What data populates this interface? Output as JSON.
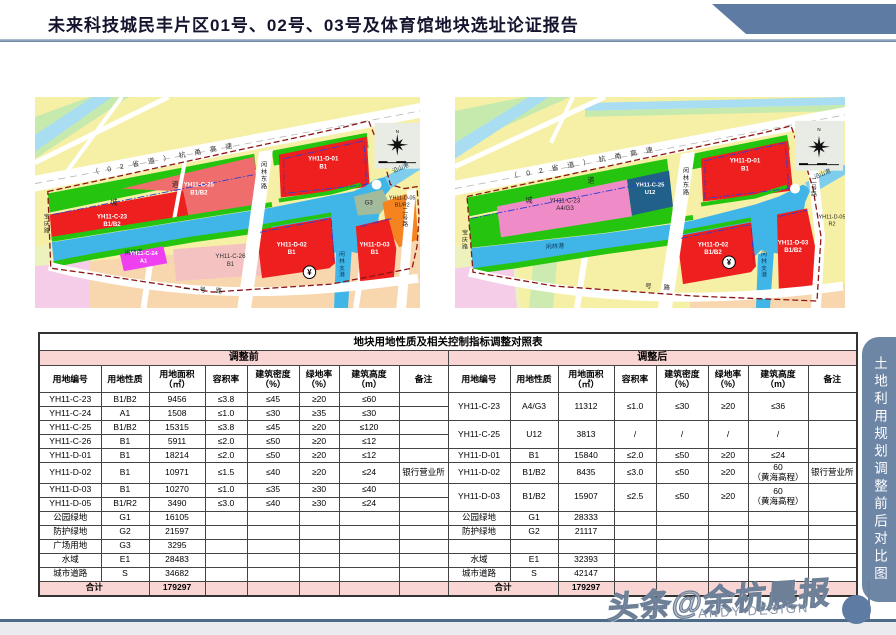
{
  "header": {
    "title": "未来科技城民丰片区01号、02号、03号及体育馆地块选址论证报告"
  },
  "side_tab": {
    "label": "土地利用规划调整前后对比图"
  },
  "footer": {
    "watermark": "头条@余杭晨报",
    "credit": "ANDY DESIGN"
  },
  "colors": {
    "banner": "#5d7ba3",
    "tab": "#6d86a6",
    "table_pink": "#f9d6d4",
    "parcel_red": "#ee1f1f",
    "water_blue": "#3fb5e8",
    "green": "#25c40f"
  },
  "maps": {
    "before": {
      "labels": [
        {
          "t": "（02省道）杭甬高速",
          "x": 58,
          "y": 78,
          "r": -10.7,
          "s": 7,
          "ls": 9,
          "a": "start",
          "c": "#333"
        },
        {
          "t": "城",
          "x": 80,
          "y": 108,
          "s": 7,
          "c": "#222"
        },
        {
          "t": "道",
          "x": 142,
          "y": 90,
          "s": 7,
          "c": "#222"
        },
        {
          "t": "宝庆路",
          "x": 12,
          "y": 122,
          "s": 6,
          "c": "#222",
          "vert": true
        },
        {
          "lines": [
            "YH11-C-23",
            "B1/B2"
          ],
          "x": 78,
          "y": 122,
          "s": 6.2,
          "c": "#ffffff",
          "w": 1
        },
        {
          "lines": [
            "YH11-C-25",
            "B1/B2"
          ],
          "x": 166,
          "y": 90,
          "s": 6.2,
          "c": "#ffffff",
          "w": 1
        },
        {
          "t": "闲林港",
          "x": 100,
          "y": 158,
          "s": 6.2,
          "c": "#0d3a5c",
          "r": -5
        },
        {
          "lines": [
            "YH11-C-24",
            "A1"
          ],
          "x": 110,
          "y": 159,
          "s": 5.8,
          "c": "#ffffff",
          "w": 1
        },
        {
          "lines": [
            "YH11-C-26",
            "B1"
          ],
          "x": 198,
          "y": 162,
          "s": 6.2,
          "c": "#333333"
        },
        {
          "t": "闲林东路",
          "x": 232,
          "y": 70,
          "s": 6.2,
          "c": "#222",
          "vert": true
        },
        {
          "lines": [
            "YH11-D-01",
            "B1"
          ],
          "x": 292,
          "y": 64,
          "s": 6.2,
          "c": "#ffffff",
          "w": 1
        },
        {
          "t": "沿山港",
          "x": 371,
          "y": 73,
          "s": 5.8,
          "c": "#0d3a5c",
          "r": -24
        },
        {
          "t": "G3",
          "x": 338,
          "y": 108,
          "s": 6.2,
          "c": "#222"
        },
        {
          "lines": [
            "YH11-D-05",
            "B1/R2"
          ],
          "x": 372,
          "y": 103,
          "s": 5.5,
          "c": "#222"
        },
        {
          "t": "二号路",
          "x": 375,
          "y": 116,
          "s": 5.8,
          "c": "#222",
          "vert": true
        },
        {
          "t": "闲林支港",
          "x": 311,
          "y": 160,
          "s": 5.8,
          "c": "#0d3a5c",
          "vert": true
        },
        {
          "lines": [
            "YH11-D-02",
            "B1"
          ],
          "x": 260,
          "y": 150,
          "s": 6.2,
          "c": "#ffffff",
          "w": 1
        },
        {
          "lines": [
            "YH11-D-03",
            "B1"
          ],
          "x": 344,
          "y": 150,
          "s": 6.2,
          "c": "#ffffff",
          "w": 1
        },
        {
          "t": "¥",
          "x": 278,
          "y": 179,
          "s": 8,
          "c": "#000",
          "w": 1
        },
        {
          "t": "一号路",
          "x": 150,
          "y": 195,
          "s": 6.5,
          "ls": 10,
          "a": "start",
          "c": "#222",
          "r": 3
        },
        {
          "t": "N",
          "x": 367,
          "y": 36,
          "s": 4.5,
          "c": "#000"
        }
      ]
    },
    "after": {
      "labels": [
        {
          "t": "（02省道）杭甬高速",
          "x": 56,
          "y": 82,
          "r": -10.7,
          "s": 7,
          "ls": 9,
          "a": "start",
          "c": "#333"
        },
        {
          "t": "城",
          "x": 74,
          "y": 106,
          "s": 7,
          "c": "#222"
        },
        {
          "t": "道",
          "x": 136,
          "y": 86,
          "s": 7,
          "c": "#222"
        },
        {
          "t": "宝庆路",
          "x": 10,
          "y": 138,
          "s": 6,
          "c": "#222",
          "vert": true
        },
        {
          "lines": [
            "YH11-C-23",
            "A4/G3"
          ],
          "x": 110,
          "y": 106,
          "s": 6.2,
          "c": "#222222"
        },
        {
          "lines": [
            "YH11-C-25",
            "U12"
          ],
          "x": 195,
          "y": 90,
          "s": 5.8,
          "c": "#ffffff",
          "w": 1
        },
        {
          "t": "闲林港",
          "x": 100,
          "y": 152,
          "s": 6.2,
          "c": "#0d3a5c",
          "r": -4
        },
        {
          "t": "闲林东路",
          "x": 231,
          "y": 76,
          "s": 6.2,
          "c": "#222",
          "vert": true
        },
        {
          "lines": [
            "YH11-D-01",
            "B1"
          ],
          "x": 290,
          "y": 66,
          "s": 6.2,
          "c": "#ffffff",
          "w": 1
        },
        {
          "t": "沿山港",
          "x": 368,
          "y": 79,
          "s": 5.8,
          "c": "#0d3a5c",
          "r": -22
        },
        {
          "t": "二号路",
          "x": 359,
          "y": 86,
          "s": 5.8,
          "c": "#222",
          "vert": true
        },
        {
          "lines": [
            "YH11-D-05",
            "R2"
          ],
          "x": 377,
          "y": 122,
          "s": 5.5,
          "c": "#222"
        },
        {
          "t": "闲林支港",
          "x": 309,
          "y": 160,
          "s": 5.8,
          "c": "#0d3a5c",
          "vert": true
        },
        {
          "lines": [
            "YH11-D-02",
            "B1/B2"
          ],
          "x": 258,
          "y": 150,
          "s": 6.2,
          "c": "#ffffff",
          "w": 1
        },
        {
          "lines": [
            "YH11-D-03",
            "B1/B2"
          ],
          "x": 338,
          "y": 148,
          "s": 6.2,
          "c": "#ffffff",
          "w": 1
        },
        {
          "t": "¥",
          "x": 274,
          "y": 169,
          "s": 8,
          "c": "#000",
          "w": 1
        },
        {
          "t": "号路",
          "x": 190,
          "y": 192,
          "s": 6.5,
          "ls": 12,
          "a": "start",
          "c": "#222",
          "r": 4
        },
        {
          "t": "N",
          "x": 364,
          "y": 34,
          "s": 4.5,
          "c": "#000"
        }
      ]
    }
  },
  "table": {
    "title": "地块用地性质及相关控制指标调整对照表",
    "halves": [
      "调整前",
      "调整后"
    ],
    "columns": [
      "用地编号",
      "用地性质",
      "用地面积\n（㎡）",
      "容积率",
      "建筑密度\n（%）",
      "绿地率\n（%）",
      "建筑高度\n（m）",
      "备注"
    ],
    "body": [
      [
        {
          "t": "YH11-C-23"
        },
        {
          "t": "B1/B2"
        },
        {
          "t": "9456"
        },
        {
          "t": "≤3.8"
        },
        {
          "t": "≤45"
        },
        {
          "t": "≥20"
        },
        {
          "t": "≤60"
        },
        {
          "t": ""
        },
        {
          "t": "YH11-C-23",
          "rs": 2
        },
        {
          "t": "A4/G3",
          "rs": 2
        },
        {
          "t": "11312",
          "rs": 2
        },
        {
          "t": "≤1.0",
          "rs": 2
        },
        {
          "t": "≤30",
          "rs": 2
        },
        {
          "t": "≥20",
          "rs": 2
        },
        {
          "t": "≤36",
          "rs": 2
        },
        {
          "t": "",
          "rs": 2
        }
      ],
      [
        {
          "t": "YH11-C-24"
        },
        {
          "t": "A1"
        },
        {
          "t": "1508"
        },
        {
          "t": "≤1.0"
        },
        {
          "t": "≤30"
        },
        {
          "t": "≥35"
        },
        {
          "t": "≤30"
        },
        {
          "t": ""
        }
      ],
      [
        {
          "t": "YH11-C-25"
        },
        {
          "t": "B1/B2"
        },
        {
          "t": "15315"
        },
        {
          "t": "≤3.8"
        },
        {
          "t": "≤45"
        },
        {
          "t": "≥20"
        },
        {
          "t": "≤120"
        },
        {
          "t": ""
        },
        {
          "t": "YH11-C-25",
          "rs": 2
        },
        {
          "t": "U12",
          "rs": 2
        },
        {
          "t": "3813",
          "rs": 2
        },
        {
          "t": "/",
          "rs": 2
        },
        {
          "t": "/",
          "rs": 2
        },
        {
          "t": "/",
          "rs": 2
        },
        {
          "t": "/",
          "rs": 2
        },
        {
          "t": "",
          "rs": 2
        }
      ],
      [
        {
          "t": "YH11-C-26"
        },
        {
          "t": "B1"
        },
        {
          "t": "5911"
        },
        {
          "t": "≤2.0"
        },
        {
          "t": "≤50"
        },
        {
          "t": "≥20"
        },
        {
          "t": "≤12"
        },
        {
          "t": ""
        }
      ],
      [
        {
          "t": "YH11-D-01"
        },
        {
          "t": "B1"
        },
        {
          "t": "18214"
        },
        {
          "t": "≤2.0"
        },
        {
          "t": "≤50"
        },
        {
          "t": "≥20"
        },
        {
          "t": "≤12"
        },
        {
          "t": ""
        },
        {
          "t": "YH11-D-01"
        },
        {
          "t": "B1"
        },
        {
          "t": "15840"
        },
        {
          "t": "≤2.0"
        },
        {
          "t": "≤50"
        },
        {
          "t": "≥20"
        },
        {
          "t": "≤24"
        },
        {
          "t": ""
        }
      ],
      [
        {
          "t": "YH11-D-02"
        },
        {
          "t": "B1"
        },
        {
          "t": "10971"
        },
        {
          "t": "≤1.5"
        },
        {
          "t": "≤40"
        },
        {
          "t": "≥20"
        },
        {
          "t": "≤24"
        },
        {
          "t": "银行营业所"
        },
        {
          "t": "YH11-D-02"
        },
        {
          "t": "B1/B2"
        },
        {
          "t": "8435"
        },
        {
          "t": "≤3.0"
        },
        {
          "t": "≤50"
        },
        {
          "t": "≥20"
        },
        {
          "t": "60\n（黄海高程）"
        },
        {
          "t": "银行营业所"
        }
      ],
      [
        {
          "t": "YH11-D-03"
        },
        {
          "t": "B1"
        },
        {
          "t": "10270"
        },
        {
          "t": "≤1.0"
        },
        {
          "t": "≤35"
        },
        {
          "t": "≥30"
        },
        {
          "t": "≤40"
        },
        {
          "t": ""
        },
        {
          "t": "YH11-D-03",
          "rs": 2
        },
        {
          "t": "B1/B2",
          "rs": 2
        },
        {
          "t": "15907",
          "rs": 2
        },
        {
          "t": "≤2.5",
          "rs": 2
        },
        {
          "t": "≤50",
          "rs": 2
        },
        {
          "t": "≥20",
          "rs": 2
        },
        {
          "t": "60\n（黄海高程）",
          "rs": 2
        },
        {
          "t": "",
          "rs": 2
        }
      ],
      [
        {
          "t": "YH11-D-05"
        },
        {
          "t": "B1/R2"
        },
        {
          "t": "3490"
        },
        {
          "t": "≤3.0"
        },
        {
          "t": "≤40"
        },
        {
          "t": "≥30"
        },
        {
          "t": "≤24"
        },
        {
          "t": ""
        }
      ],
      [
        {
          "t": "公园绿地"
        },
        {
          "t": "G1"
        },
        {
          "t": "16105"
        },
        {},
        {},
        {},
        {},
        {},
        {
          "t": "公园绿地"
        },
        {
          "t": "G1"
        },
        {
          "t": "28333"
        },
        {},
        {},
        {},
        {},
        {}
      ],
      [
        {
          "t": "防护绿地"
        },
        {
          "t": "G2"
        },
        {
          "t": "21597"
        },
        {},
        {},
        {},
        {},
        {},
        {
          "t": "防护绿地"
        },
        {
          "t": "G2"
        },
        {
          "t": "21117"
        },
        {},
        {},
        {},
        {},
        {}
      ],
      [
        {
          "t": "广场用地"
        },
        {
          "t": "G3"
        },
        {
          "t": "3295"
        },
        {},
        {},
        {},
        {},
        {},
        {},
        {},
        {},
        {},
        {},
        {},
        {},
        {}
      ],
      [
        {
          "t": "水域"
        },
        {
          "t": "E1"
        },
        {
          "t": "28483"
        },
        {},
        {},
        {},
        {},
        {},
        {
          "t": "水域"
        },
        {
          "t": "E1"
        },
        {
          "t": "32393"
        },
        {},
        {},
        {},
        {},
        {}
      ],
      [
        {
          "t": "城市道路"
        },
        {
          "t": "S"
        },
        {
          "t": "34682"
        },
        {},
        {},
        {},
        {},
        {},
        {
          "t": "城市道路"
        },
        {
          "t": "S"
        },
        {
          "t": "42147"
        },
        {},
        {},
        {},
        {},
        {}
      ],
      [
        {
          "t": "合计",
          "cs": 2,
          "c": "pk b"
        },
        {
          "t": "179297",
          "c": "pk b"
        },
        {
          "c": "pk"
        },
        {
          "c": "pk"
        },
        {
          "c": "pk"
        },
        {
          "c": "pk"
        },
        {
          "c": "pk"
        },
        {
          "t": "合计",
          "cs": 2,
          "c": "pk b"
        },
        {
          "t": "179297",
          "c": "pk b"
        },
        {
          "c": "pk"
        },
        {
          "c": "pk"
        },
        {
          "c": "pk"
        },
        {
          "c": "pk"
        },
        {
          "c": "pk"
        }
      ]
    ]
  }
}
